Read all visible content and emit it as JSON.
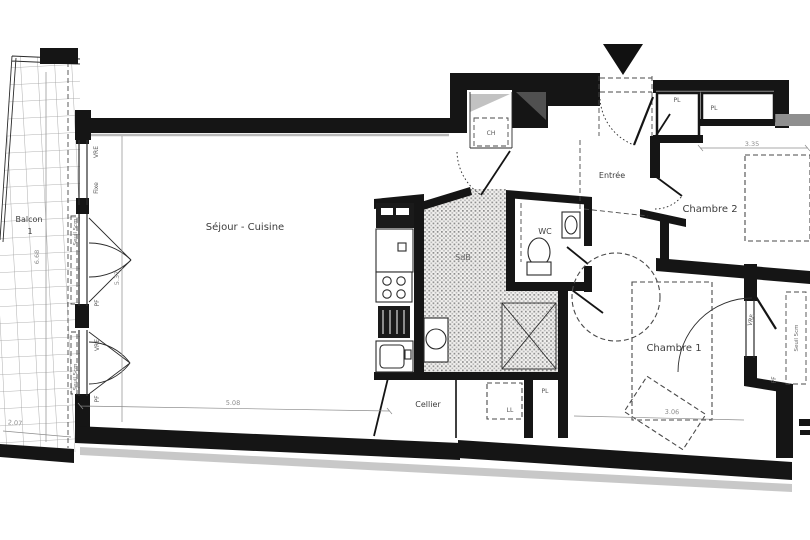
{
  "colors": {
    "wall": "#151515",
    "line": "#2b2b2b",
    "dim": "#8c8c8c",
    "shadow": "#9a9a9a",
    "text": "#3d3d3d",
    "bg": "#ffffff"
  },
  "rooms": {
    "balcon": {
      "name": "Balcon",
      "number": "1"
    },
    "sejour": {
      "name": "Séjour - Cuisine"
    },
    "entree": {
      "name": "Entrée"
    },
    "wc": {
      "name": "WC"
    },
    "sdb": {
      "name": "SdB"
    },
    "cellier": {
      "name": "Cellier"
    },
    "chambre1": {
      "name": "Chambre 1"
    },
    "chambre2": {
      "name": "Chambre 2"
    }
  },
  "closets": {
    "pl_top_left": "PL",
    "pl_top_right": "PL",
    "pl_hall": "PL"
  },
  "equipment": {
    "water_heater": "CH",
    "washing_machine": "LL"
  },
  "openings": {
    "vre_left_top": "VRE",
    "fixe_left": "Fixe",
    "seuil_left_top": "Seuil 5cm",
    "pf_left_top": "PF",
    "vre_left_bottom": "VRE",
    "seuil_left_bottom": "Seuil 5cm",
    "pf_left_bottom": "PF",
    "vre_right": "VRE",
    "pf_right": "PF",
    "seuil_right": "Seuil 5cm"
  },
  "dimensions": {
    "balcon_height": "6.68",
    "balcon_width": "2.07",
    "sejour_height": "5.37",
    "sejour_width": "5.08",
    "chambre2_width": "3.35",
    "chambre1_width": "3.06"
  }
}
